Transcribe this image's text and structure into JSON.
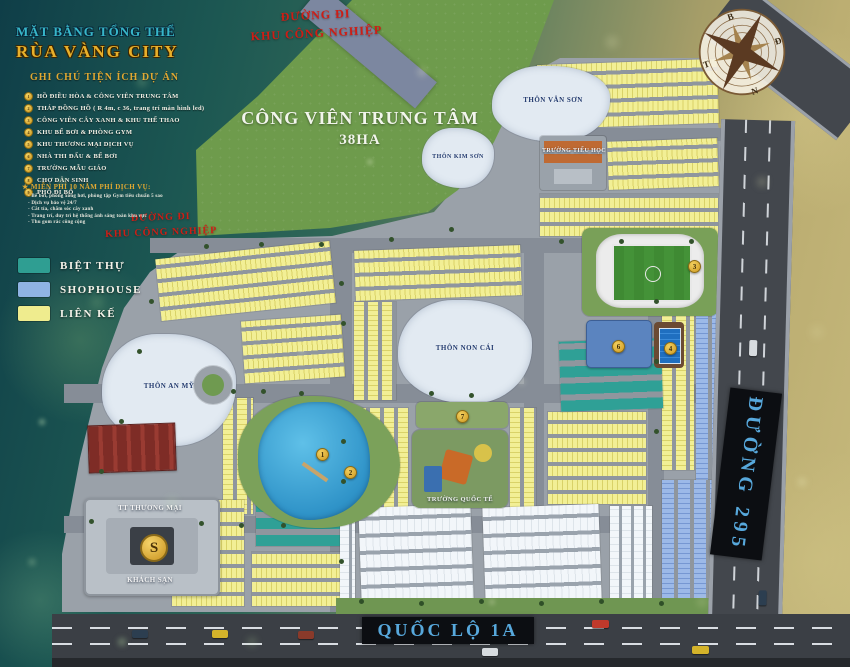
{
  "title": {
    "line1": "MẶT BẰNG TỔNG THỂ",
    "line2": "RÙA VÀNG CITY"
  },
  "legend": {
    "header": "GHI CHÚ TIỆN ÍCH DỰ ÁN",
    "items": [
      {
        "num": "1",
        "label": "HỒ ĐIỀU HÒA & CÔNG VIÊN TRUNG TÂM"
      },
      {
        "num": "2",
        "label": "THÁP ĐỒNG HỒ ( R 4m, c 36, trang trí màn hình led)"
      },
      {
        "num": "3",
        "label": "CÔNG VIÊN CÂY XANH & KHU THỂ THAO"
      },
      {
        "num": "4",
        "label": "KHU BỂ BƠI & PHÒNG GYM"
      },
      {
        "num": "5",
        "label": "KHU THƯƠNG MẠI DỊCH VỤ"
      },
      {
        "num": "6",
        "label": "NHÀ THI ĐẤU & BỂ BƠI"
      },
      {
        "num": "7",
        "label": "TRƯỜNG MẪU GIÁO"
      },
      {
        "num": "8",
        "label": "CHỢ DÂN SINH"
      },
      {
        "num": "9",
        "label": "PHỐ ĐI BỘ"
      }
    ],
    "free_services": {
      "header": "MIỄN PHÍ 10 NĂM PHÍ DỊCH VỤ:",
      "items": [
        "- Bể bơi, phòng xông hơi, phòng tập Gym tiêu chuẩn 5 sao",
        "- Dịch vụ bảo vệ 24/7",
        "- Cắt tỉa, chăm sóc cây xanh",
        "- Trang trí, duy trì hệ thống ánh sáng toàn khu vực",
        "- Thu gom rác công cộng"
      ]
    },
    "housing_types": [
      {
        "label": "BIỆT THỰ",
        "color": "#2f9e92"
      },
      {
        "label": "SHOPHOUSE",
        "color": "#8fb3e3"
      },
      {
        "label": "LIÊN KẾ",
        "color": "#efec8e"
      }
    ]
  },
  "roads": {
    "industrial_road_top": {
      "line1": "ĐƯỜNG ĐI",
      "line2": "KHU CÔNG NGHIỆP"
    },
    "industrial_road_left": {
      "line1": "ĐƯỜNG ĐI",
      "line2": "KHU CÔNG NGHIỆP"
    },
    "route_295": "ĐƯỜNG 295",
    "national_highway": "QUỐC LỘ 1A"
  },
  "park": {
    "name": "CÔNG VIÊN TRUNG TÂM",
    "area": "38HA"
  },
  "areas": {
    "van_son": "THÔN VÂN SƠN",
    "kim_son": "THÔN KIM SƠN",
    "non_cai": "THÔN NON CÁI",
    "an_my": "THÔN AN MỸ",
    "primary_school": "TRƯỜNG TIỂU HỌC",
    "intl_school": "TRƯỜNG QUỐC TẾ",
    "commercial_center": "TT THƯƠNG MẠI",
    "hotel": "KHÁCH SẠN"
  },
  "compass": {
    "north": "B",
    "east": "Đ",
    "south": "N",
    "west": "T"
  },
  "logo_letter": "S"
}
